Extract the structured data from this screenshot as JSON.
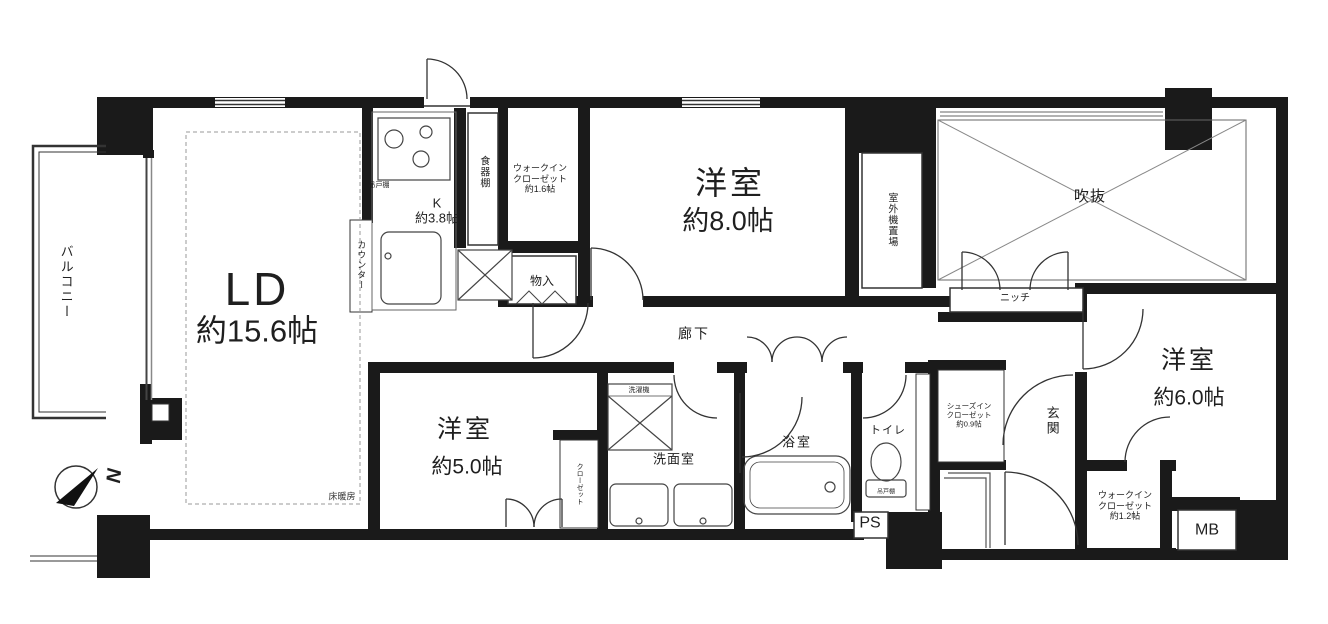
{
  "title": "マンション間取り図 (3LDK floor plan)",
  "colors": {
    "wall": "#1a1a1a",
    "line": "#444444",
    "thin_line": "#888888",
    "bg": "#ffffff",
    "text": "#1f1f1f"
  },
  "compass": {
    "north_label": "N"
  },
  "rooms": {
    "balcony": "バルコニー",
    "ld_name": "LD",
    "ld_area": "約15.6帖",
    "kitchen": "K\n約3.8帖",
    "western8_name": "洋室",
    "western8_area": "約8.0帖",
    "western5_name": "洋室",
    "western5_area": "約5.0帖",
    "western6_name": "洋室",
    "western6_area": "約6.0帖",
    "atrium": "吹抜",
    "hallway": "廊下",
    "entrance": "玄関",
    "washroom": "洗面室",
    "bathroom": "浴室",
    "toilet": "トイレ"
  },
  "storage": {
    "wic_1_6": "ウォークイン\nクローゼット\n約1.6帖",
    "wic_1_2": "ウォークイン\nクローゼット\n約1.2帖",
    "shoes_in_closet": "シューズイン\nクローゼット\n約0.9帖",
    "closet": "クローゼット",
    "monoire": "物入",
    "cupboard": "食器棚",
    "hanging_cupboard_kitchen": "吊戸棚",
    "hanging_cupboard_toilet": "吊戸棚"
  },
  "annotations": {
    "counter": "カウンター",
    "outdoor_unit": "室外機置場",
    "niche": "ニッチ",
    "floor_heating": "床暖房",
    "washer": "洗濯機",
    "ps": "PS",
    "mb": "MB"
  }
}
